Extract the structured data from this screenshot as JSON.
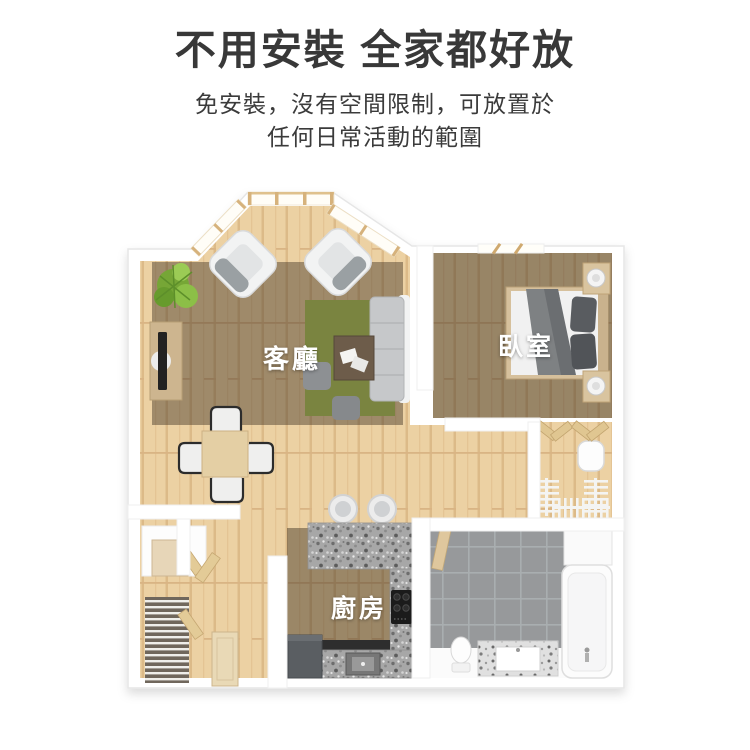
{
  "header": {
    "title": "不用安裝 全家都好放",
    "subtitle_lines": [
      "免安裝，沒有空間限制，可放置於",
      "任何日常活動的範圍"
    ]
  },
  "floorplan": {
    "rooms": [
      {
        "name": "living-room",
        "label": "客廳"
      },
      {
        "name": "bedroom",
        "label": "臥室"
      },
      {
        "name": "kitchen",
        "label": "廚房"
      }
    ],
    "colors": {
      "background": "#ffffff",
      "heading_text": "#383838",
      "room_label_text": "#ffffff",
      "wall_white": "#ffffff",
      "wood_floor": "#ecd1a3",
      "room_shade_overlay": "rgba(52,40,28,0.44)",
      "rug_green": "#7a8440",
      "bathroom_tile_gray": "#97999b",
      "granite_counter_gray": "#a7a7a7",
      "sofa_gray": "#c6c8ca",
      "blanket_gray": "#7e8183",
      "plant_green": "#8cbf47"
    }
  }
}
